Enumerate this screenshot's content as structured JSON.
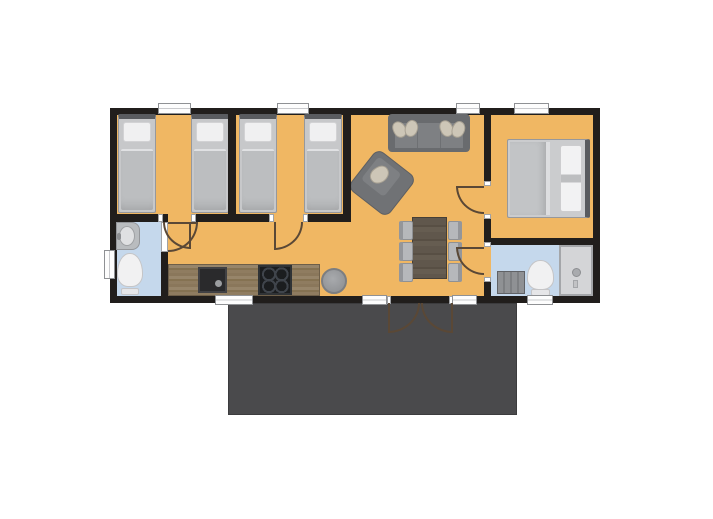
{
  "floorplan": {
    "canvas": {
      "width": 713,
      "height": 519,
      "background": "#ffffff"
    },
    "palette": {
      "wall": "#211e1c",
      "floor": "#f0b763",
      "bathFloor": "#c5d8ec",
      "deck": "#4a4a4c",
      "windowFill": "#fdfdfd",
      "windowFrame": "#8f9194",
      "doorArc": "#5a4836",
      "pillowBeige": "#cdc6b7"
    },
    "base": [
      {
        "name": "deck-terrace",
        "type": "deck",
        "rect": [
          228,
          303,
          289,
          112
        ]
      },
      {
        "name": "building-outline",
        "type": "wallrect",
        "rect": [
          110,
          108,
          490,
          195
        ]
      },
      {
        "name": "main-floor",
        "type": "floor",
        "rect": [
          117,
          115,
          476,
          181
        ]
      },
      {
        "name": "bathroom1-floor",
        "type": "bathfloor",
        "rect": [
          117,
          221,
          44,
          75
        ]
      },
      {
        "name": "bathroom2-floor",
        "type": "bathfloor",
        "rect": [
          491,
          245,
          102,
          51
        ]
      }
    ],
    "furniture": [
      {
        "name": "bed-single-1",
        "type": "bed-single",
        "rect": [
          118,
          114,
          38,
          99
        ]
      },
      {
        "name": "bed-single-2",
        "type": "bed-single",
        "rect": [
          191,
          114,
          38,
          99
        ]
      },
      {
        "name": "bed-single-3",
        "type": "bed-single",
        "rect": [
          239,
          114,
          38,
          99
        ]
      },
      {
        "name": "bed-single-4",
        "type": "bed-single",
        "rect": [
          304,
          114,
          38,
          99
        ]
      },
      {
        "name": "sofa",
        "type": "sofa",
        "rect": [
          388,
          114,
          82,
          38
        ]
      },
      {
        "name": "sofa-pillow-1",
        "type": "pillow",
        "rect": [
          393,
          121,
          13,
          17
        ],
        "rot": -25
      },
      {
        "name": "sofa-pillow-2",
        "type": "pillow",
        "rect": [
          405,
          120,
          13,
          17
        ],
        "rot": 20
      },
      {
        "name": "sofa-pillow-3",
        "type": "pillow",
        "rect": [
          440,
          120,
          13,
          17
        ],
        "rot": -20
      },
      {
        "name": "sofa-pillow-4",
        "type": "pillow",
        "rect": [
          452,
          121,
          13,
          17
        ],
        "rot": 25
      },
      {
        "name": "armchair",
        "type": "armchair",
        "rect": [
          357,
          158,
          50,
          50
        ],
        "rot": 38
      },
      {
        "name": "dining-table",
        "type": "table",
        "rect": [
          412,
          217,
          35,
          62
        ]
      },
      {
        "name": "chair-1",
        "type": "chair",
        "variant": "left",
        "rect": [
          399,
          221,
          14,
          19
        ]
      },
      {
        "name": "chair-2",
        "type": "chair",
        "variant": "left",
        "rect": [
          399,
          242,
          14,
          19
        ]
      },
      {
        "name": "chair-3",
        "type": "chair",
        "variant": "left",
        "rect": [
          399,
          263,
          14,
          19
        ]
      },
      {
        "name": "chair-4",
        "type": "chair",
        "variant": "right",
        "rect": [
          448,
          221,
          14,
          19
        ]
      },
      {
        "name": "chair-5",
        "type": "chair",
        "variant": "right",
        "rect": [
          448,
          242,
          14,
          19
        ]
      },
      {
        "name": "chair-6",
        "type": "chair",
        "variant": "right",
        "rect": [
          448,
          263,
          14,
          19
        ]
      },
      {
        "name": "pouf",
        "type": "pouf",
        "rect": [
          321,
          268,
          26,
          26
        ]
      },
      {
        "name": "kitchen-counter",
        "type": "counter",
        "rect": [
          168,
          264,
          152,
          32
        ]
      },
      {
        "name": "kitchen-sink",
        "type": "ksink",
        "rect": [
          198,
          267,
          29,
          26
        ]
      },
      {
        "name": "cooktop",
        "type": "cooktop",
        "rect": [
          258,
          265,
          34,
          30
        ]
      },
      {
        "name": "bathroom1-sink",
        "type": "vanity",
        "rect": [
          116,
          222,
          24,
          28
        ]
      },
      {
        "name": "bathroom1-toilet",
        "type": "toilet",
        "rect": [
          117,
          253,
          26,
          42
        ]
      },
      {
        "name": "bed-double",
        "type": "bed-double",
        "rect": [
          507,
          139,
          83,
          79
        ]
      },
      {
        "name": "bathroom2-cabinet",
        "type": "cabinet",
        "rect": [
          497,
          271,
          28,
          23
        ]
      },
      {
        "name": "bathroom2-toilet",
        "type": "toilet",
        "rect": [
          527,
          260,
          27,
          36
        ]
      },
      {
        "name": "shower",
        "type": "shower",
        "rect": [
          559,
          245,
          34,
          51
        ]
      }
    ],
    "walls": [
      {
        "name": "wall-bedroom-a-b",
        "rect": [
          228,
          108,
          8,
          114
        ]
      },
      {
        "name": "wall-bedroom-b-living",
        "rect": [
          343,
          108,
          8,
          114
        ]
      },
      {
        "name": "wall-bedrooms-south-1",
        "rect": [
          110,
          214,
          48,
          8
        ]
      },
      {
        "name": "wall-bedrooms-south-2",
        "rect": [
          196,
          214,
          73,
          8
        ]
      },
      {
        "name": "wall-bedrooms-south-3",
        "rect": [
          308,
          214,
          43,
          8
        ]
      },
      {
        "name": "wall-bathroom1-east-top",
        "rect": [
          161,
          214,
          7,
          8
        ]
      },
      {
        "name": "wall-bathroom1-east-bottom",
        "rect": [
          161,
          252,
          7,
          44
        ]
      },
      {
        "name": "wall-living-east-upper",
        "rect": [
          484,
          108,
          7,
          73
        ]
      },
      {
        "name": "wall-living-east-mid",
        "rect": [
          484,
          219,
          7,
          23
        ]
      },
      {
        "name": "wall-living-east-lower",
        "rect": [
          484,
          282,
          7,
          14
        ]
      },
      {
        "name": "wall-master-bathroom2",
        "rect": [
          484,
          238,
          116,
          7
        ]
      }
    ],
    "ticks": [
      {
        "name": "jamb-bedroom-a-left",
        "rect": [
          158,
          214,
          5,
          8
        ]
      },
      {
        "name": "jamb-bedroom-a-right",
        "rect": [
          191,
          214,
          5,
          8
        ]
      },
      {
        "name": "jamb-bedroom-b-left",
        "rect": [
          269,
          214,
          5,
          8
        ]
      },
      {
        "name": "jamb-bedroom-b-right",
        "rect": [
          303,
          214,
          5,
          8
        ]
      },
      {
        "name": "jamb-master-top",
        "rect": [
          484,
          181,
          7,
          5
        ]
      },
      {
        "name": "jamb-master-bottom",
        "rect": [
          484,
          214,
          7,
          5
        ]
      },
      {
        "name": "jamb-bathroom2-top",
        "rect": [
          484,
          242,
          7,
          5
        ]
      },
      {
        "name": "jamb-bathroom2-bottom",
        "rect": [
          484,
          277,
          7,
          5
        ]
      },
      {
        "name": "door-leaf-bathroom1",
        "rect": [
          161,
          222,
          7,
          30
        ]
      },
      {
        "name": "jamb-entry-left",
        "rect": [
          387,
          296,
          4,
          8
        ]
      },
      {
        "name": "jamb-entry-right",
        "rect": [
          449,
          296,
          4,
          8
        ]
      }
    ],
    "windows": [
      {
        "name": "window-bedroom-a",
        "rect": [
          158,
          103,
          33,
          11
        ]
      },
      {
        "name": "window-bedroom-b",
        "rect": [
          277,
          103,
          32,
          11
        ]
      },
      {
        "name": "window-living",
        "rect": [
          456,
          103,
          24,
          11
        ]
      },
      {
        "name": "window-master-bedroom",
        "rect": [
          514,
          103,
          35,
          11
        ]
      },
      {
        "name": "window-kitchen",
        "rect": [
          215,
          295,
          38,
          10
        ]
      },
      {
        "name": "window-entry-sidelight-left",
        "rect": [
          362,
          295,
          25,
          10
        ]
      },
      {
        "name": "window-entry-sidelight-right",
        "rect": [
          452,
          295,
          25,
          10
        ]
      },
      {
        "name": "window-bathroom2",
        "rect": [
          527,
          295,
          26,
          10
        ]
      },
      {
        "name": "window-bathroom1",
        "rect": [
          104,
          250,
          11,
          29
        ],
        "v": true
      }
    ],
    "doors": [
      {
        "name": "door-bedroom-a",
        "rect": [
          163,
          222,
          28,
          27
        ],
        "corner": "bl",
        "leaf": "right"
      },
      {
        "name": "door-bedroom-b",
        "rect": [
          274,
          222,
          29,
          28
        ],
        "corner": "br",
        "leaf": "left"
      },
      {
        "name": "door-bathroom1",
        "rect": [
          168,
          222,
          30,
          30
        ],
        "corner": "br",
        "leaf": "top"
      },
      {
        "name": "door-master-bedroom",
        "rect": [
          456,
          186,
          28,
          28
        ],
        "corner": "bl",
        "leaf": "top"
      },
      {
        "name": "door-bathroom2",
        "rect": [
          456,
          247,
          28,
          28
        ],
        "corner": "bl",
        "leaf": "top"
      },
      {
        "name": "door-entry-left",
        "rect": [
          388,
          303,
          32,
          30
        ],
        "corner": "br",
        "leaf": "left"
      },
      {
        "name": "door-entry-right",
        "rect": [
          421,
          303,
          32,
          30
        ],
        "corner": "bl",
        "leaf": "right"
      }
    ]
  }
}
